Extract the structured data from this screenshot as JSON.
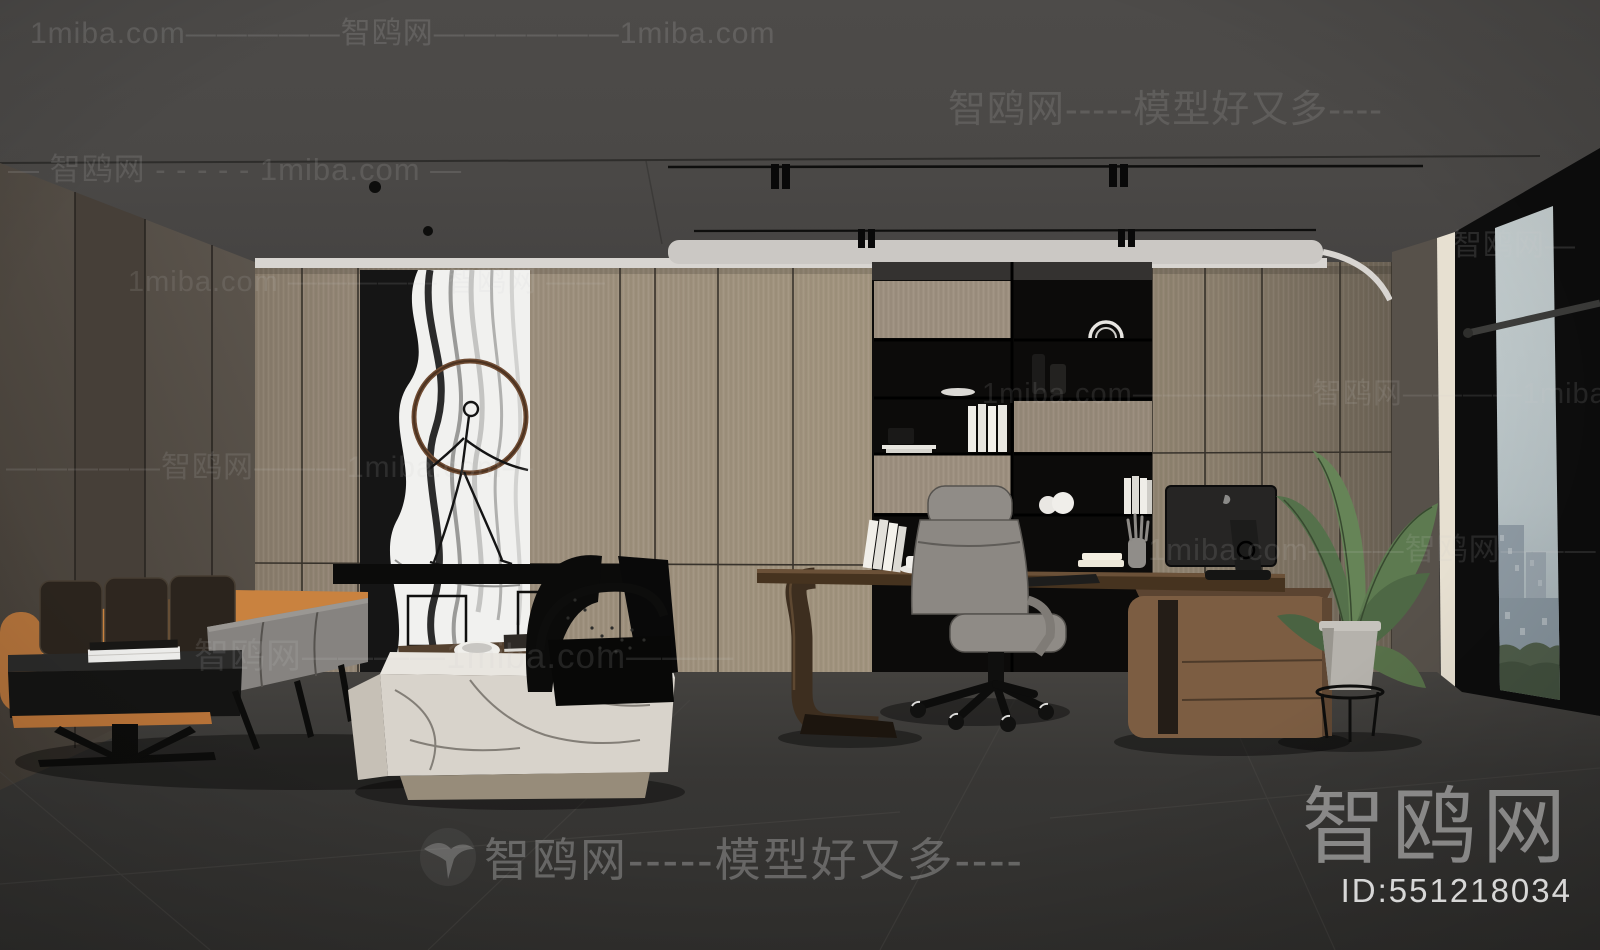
{
  "watermarks": {
    "top_left_row": "1miba.com—————智鸥网——————1miba.com",
    "top_right_row": "智鸥网-----模型好又多----",
    "rows": [
      {
        "text": "— 智鸥网 - - - - - 1miba.com —"
      },
      {
        "text": "1miba.com ————— 智鸥网 ——"
      },
      {
        "text": "1miba.com——————智鸥网————1miba.com"
      },
      {
        "text": "—————智鸥网———1miba.com—"
      },
      {
        "text": "1miba.com———智鸥网———"
      },
      {
        "text": "智鸥网————1miba.com———"
      },
      {
        "text": "智鸥网—"
      }
    ],
    "bottom_brand": {
      "logo": "seagull-icon",
      "text": "智鸥网-----模型好又多----"
    },
    "corner": {
      "brand": "智鸥网",
      "id_label": "ID:551218034"
    }
  },
  "palette": {
    "ceiling": "#4b4947",
    "back_wall_wood": "#9d9080",
    "left_wall": "#544d45",
    "floor": "#393837",
    "sofa_leather_accent": "#c9823f",
    "sofa_cushion_dark": "#2b241d",
    "sofa_seat_gray": "#868380",
    "marble_table": "#e3dfd8",
    "desk_brown": "#46331f",
    "cabinet_brown": "#7c5d42",
    "chair_gray": "#8f8b86",
    "plant_green": "#5d7a50",
    "recessed_light": "#cbc8c4",
    "window_sky": "#bcc6c8",
    "watermark_gray": "#cfcfcf"
  }
}
